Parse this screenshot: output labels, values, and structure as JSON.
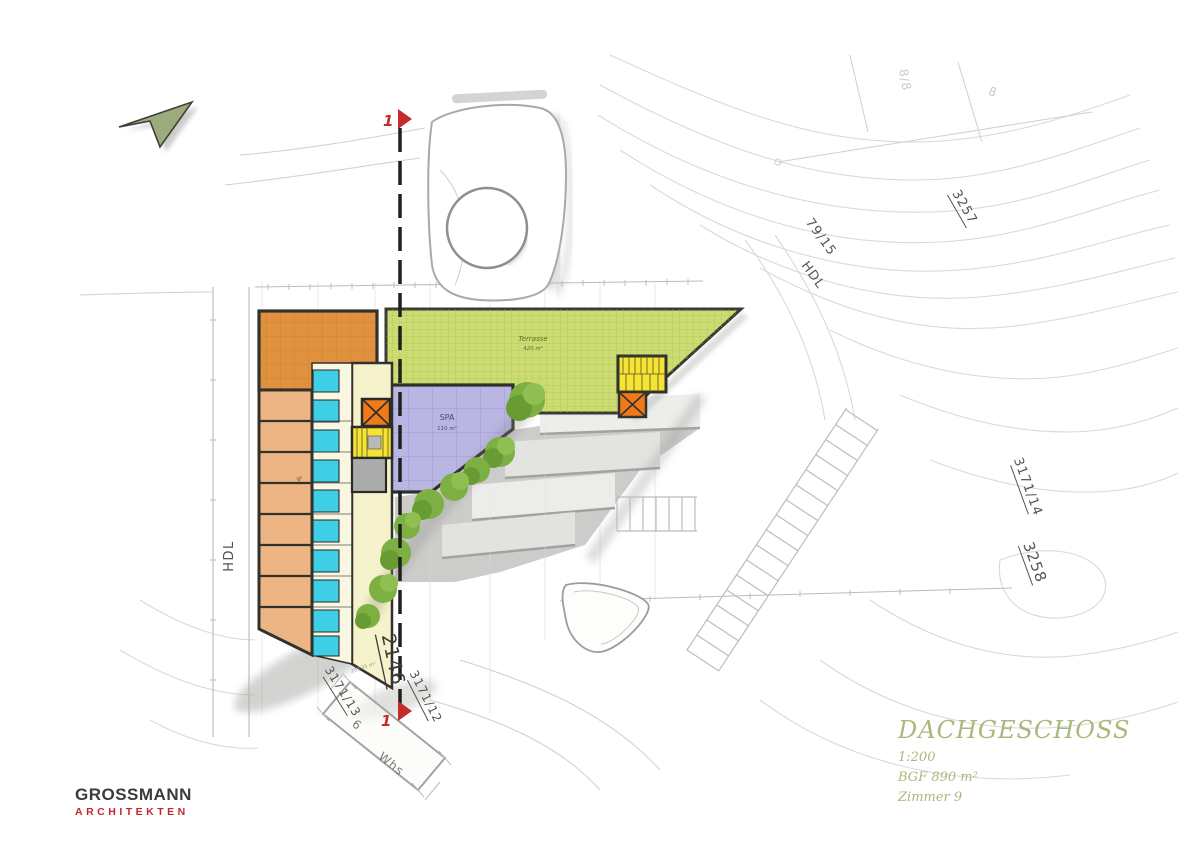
{
  "title_block": {
    "title": "DACHGESCHOSS",
    "scale": "1:200",
    "area": "BGF 890 m²",
    "rooms": "Zimmer 9"
  },
  "logo": {
    "name": "GROSSMANN",
    "subtitle": "ARCHITEKTEN"
  },
  "plan": {
    "labels": {
      "road_left": "HDL",
      "road_upper": "HDL",
      "parcel_79_15": "79/15",
      "parcel_3257": "3257",
      "parcel_3171_14": "3171/14",
      "parcel_3258": "3258",
      "parcel_2146": "2146",
      "parcel_3171_13": "3171/13",
      "parcel_3171_12": "3171/12",
      "house_8_8": "8/8",
      "house_8": "8",
      "house_6": "6",
      "whs": "Whs",
      "terrace": "Terrasse",
      "terrace_area": "420 m²",
      "spa": "SPA",
      "spa_area": "110 m²",
      "room_4": "4",
      "plot_note": "203.35 m²"
    },
    "section_marker": "1"
  },
  "colors": {
    "terrace": "#ccdb72",
    "spa": "#b9b6e4",
    "room_dark": "#e0913e",
    "room_light": "#ecb583",
    "bath": "#3ecfe6",
    "corridor": "#f6f2cc",
    "stair": "#f7e335",
    "elevator": "#ef7a1c",
    "utility_gray": "#ababab",
    "marker_red": "#c62b2b",
    "north_green": "#9bab7d",
    "title_olive": "#a9b87b",
    "logo_red": "#c2272d"
  }
}
